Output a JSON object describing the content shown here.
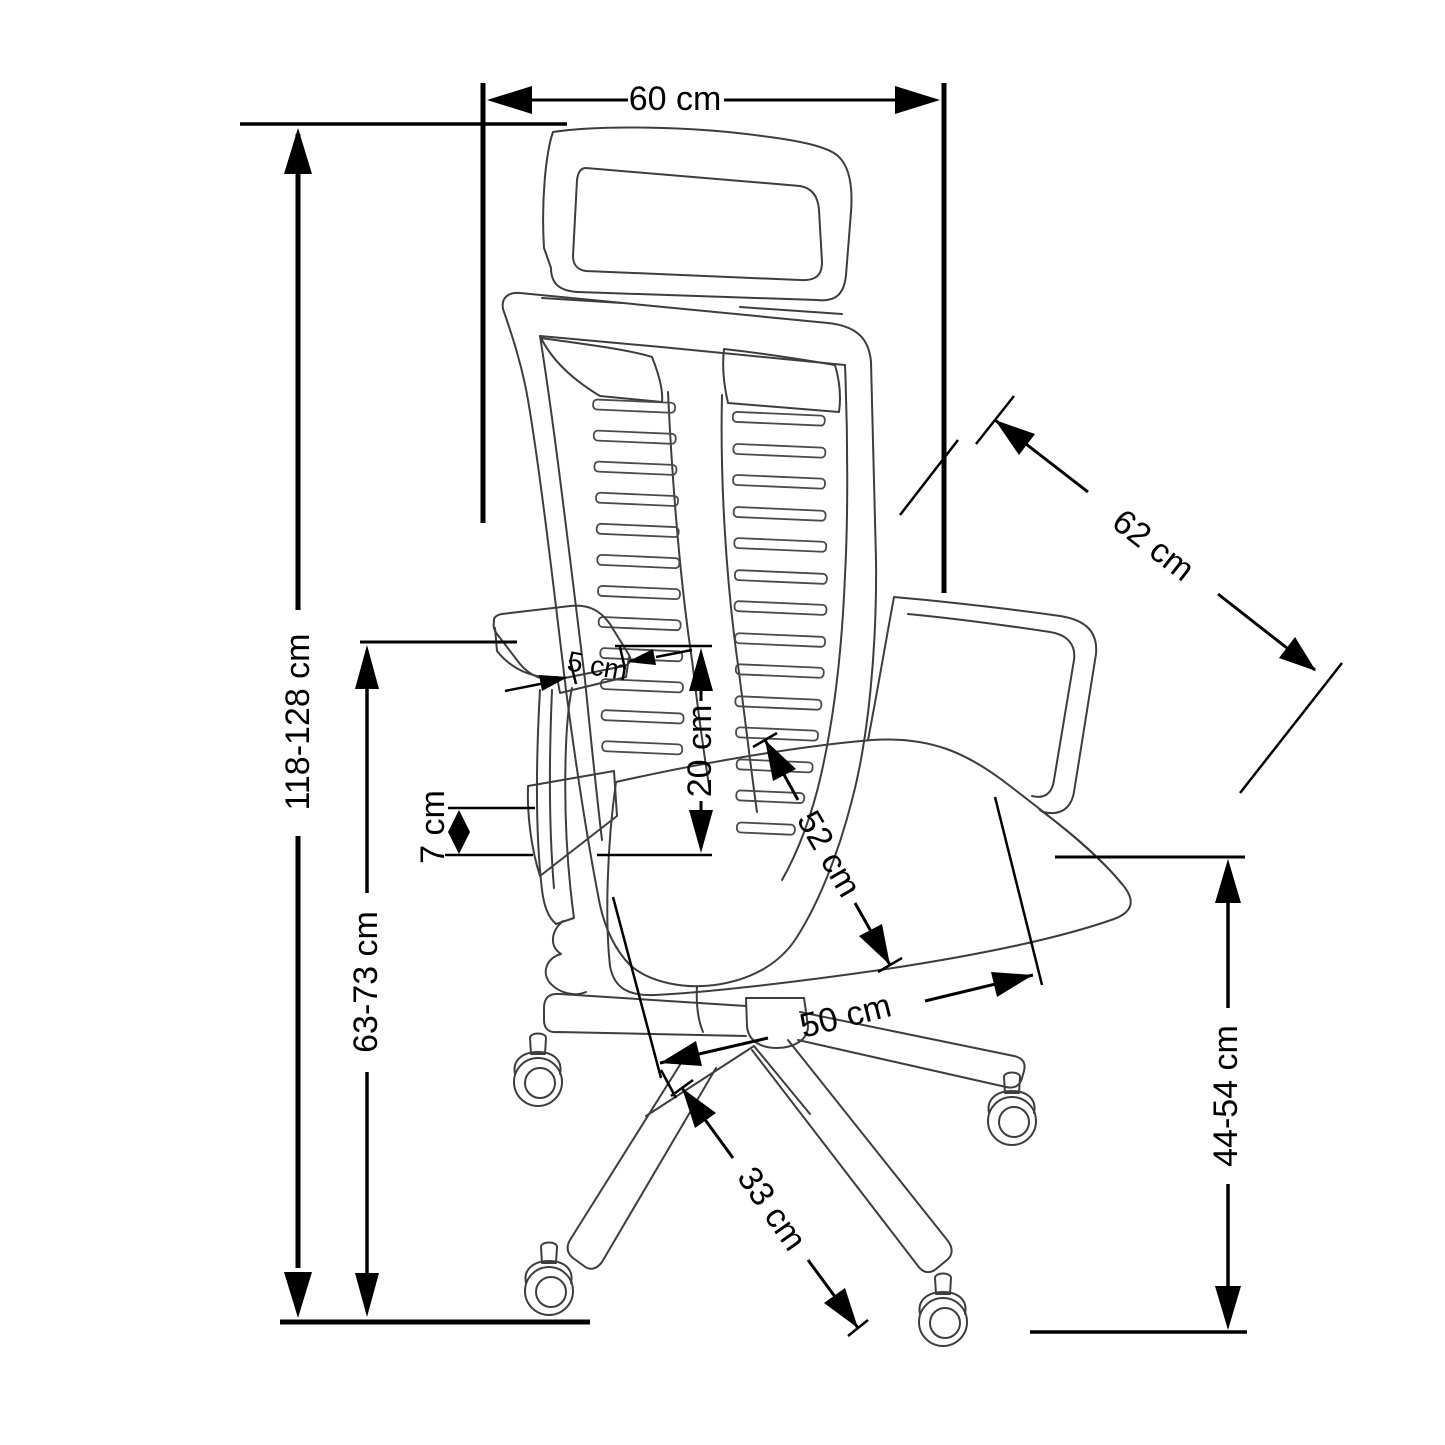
{
  "diagram": {
    "subject": "Office swivel chair technical dimension drawing",
    "unit": "cm",
    "colors": {
      "line": "#3d3d3d",
      "dimension": "#000000",
      "background": "#ffffff"
    },
    "labels": {
      "top_width": "60 cm",
      "backrest_diagonal": "62 cm",
      "overall_height": "118-128 cm",
      "armrest_height": "63-73 cm",
      "armrest_pad_thickness": "7 cm",
      "armrest_frame_width": "5 cm",
      "backrest_to_armrest": "20 cm",
      "seat_depth": "52 cm",
      "seat_width": "50 cm",
      "base_leg_length": "33 cm",
      "seat_height": "44-54 cm"
    }
  }
}
